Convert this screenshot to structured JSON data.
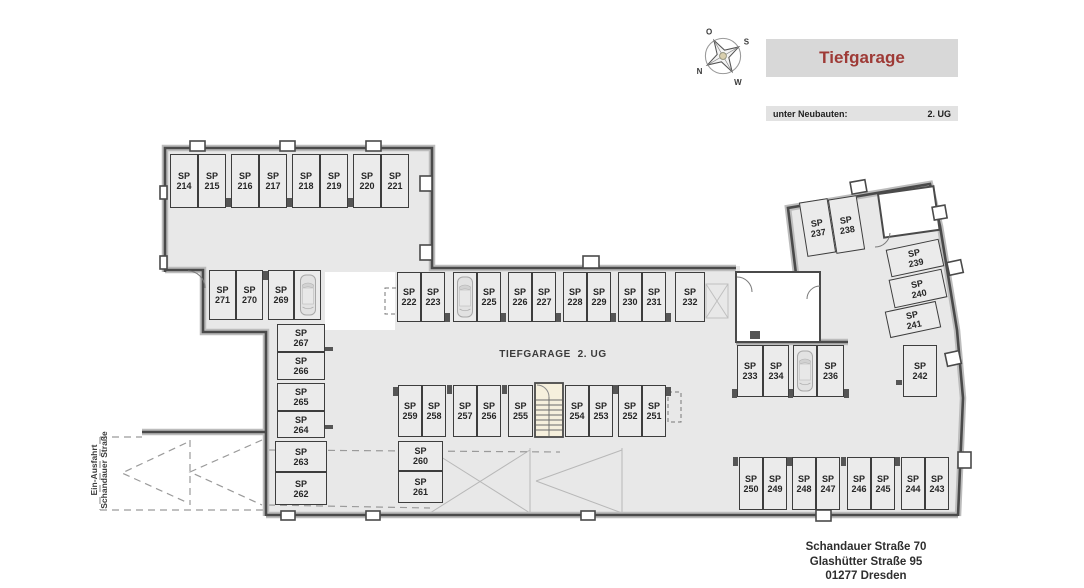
{
  "header": {
    "title": "Tiefgarage",
    "subtitle_left": "unter Neubauten:",
    "subtitle_right": "2. UG"
  },
  "compass": {
    "top": "O",
    "right": "S",
    "bottom": "W",
    "left": "N"
  },
  "plan": {
    "area_label": "TIEFGARAGE  2. UG",
    "entrance_line1": "Ein-Ausfahrt",
    "entrance_line2": "Schandauer Straße"
  },
  "footer": {
    "address_line1": "Schandauer Straße 70",
    "address_line2": "Glashütter Straße 95",
    "address_line3": "01277 Dresden"
  },
  "colors": {
    "accent_red": "#9e3a36",
    "floor": "#e8e8e8",
    "wall": "#4a4a4a",
    "stair_fill": "#f6f0dd"
  },
  "spots": [
    {
      "label": "SP",
      "num": "214"
    },
    {
      "label": "SP",
      "num": "215"
    },
    {
      "label": "SP",
      "num": "216"
    },
    {
      "label": "SP",
      "num": "217"
    },
    {
      "label": "SP",
      "num": "218"
    },
    {
      "label": "SP",
      "num": "219"
    },
    {
      "label": "SP",
      "num": "220"
    },
    {
      "label": "SP",
      "num": "221"
    },
    {
      "label": "SP",
      "num": "222"
    },
    {
      "label": "SP",
      "num": "223"
    },
    {
      "label": "SP",
      "num": "224"
    },
    {
      "label": "SP",
      "num": "225"
    },
    {
      "label": "SP",
      "num": "226"
    },
    {
      "label": "SP",
      "num": "227"
    },
    {
      "label": "SP",
      "num": "228"
    },
    {
      "label": "SP",
      "num": "229"
    },
    {
      "label": "SP",
      "num": "230"
    },
    {
      "label": "SP",
      "num": "231"
    },
    {
      "label": "SP",
      "num": "232"
    },
    {
      "label": "SP",
      "num": "233"
    },
    {
      "label": "SP",
      "num": "234"
    },
    {
      "label": "SP",
      "num": "235"
    },
    {
      "label": "SP",
      "num": "236"
    },
    {
      "label": "SP",
      "num": "237"
    },
    {
      "label": "SP",
      "num": "238"
    },
    {
      "label": "SP",
      "num": "239"
    },
    {
      "label": "SP",
      "num": "240"
    },
    {
      "label": "SP",
      "num": "241"
    },
    {
      "label": "SP",
      "num": "242"
    },
    {
      "label": "SP",
      "num": "243"
    },
    {
      "label": "SP",
      "num": "244"
    },
    {
      "label": "SP",
      "num": "245"
    },
    {
      "label": "SP",
      "num": "246"
    },
    {
      "label": "SP",
      "num": "247"
    },
    {
      "label": "SP",
      "num": "248"
    },
    {
      "label": "SP",
      "num": "249"
    },
    {
      "label": "SP",
      "num": "250"
    },
    {
      "label": "SP",
      "num": "251"
    },
    {
      "label": "SP",
      "num": "252"
    },
    {
      "label": "SP",
      "num": "253"
    },
    {
      "label": "SP",
      "num": "254"
    },
    {
      "label": "SP",
      "num": "255"
    },
    {
      "label": "SP",
      "num": "256"
    },
    {
      "label": "SP",
      "num": "257"
    },
    {
      "label": "SP",
      "num": "258"
    },
    {
      "label": "SP",
      "num": "259"
    },
    {
      "label": "SP",
      "num": "260"
    },
    {
      "label": "SP",
      "num": "261"
    },
    {
      "label": "SP",
      "num": "262"
    },
    {
      "label": "SP",
      "num": "263"
    },
    {
      "label": "SP",
      "num": "264"
    },
    {
      "label": "SP",
      "num": "265"
    },
    {
      "label": "SP",
      "num": "266"
    },
    {
      "label": "SP",
      "num": "267"
    },
    {
      "label": "SP",
      "num": "268"
    },
    {
      "label": "SP",
      "num": "269"
    },
    {
      "label": "SP",
      "num": "270"
    },
    {
      "label": "SP",
      "num": "271"
    }
  ],
  "cars_on": [
    "224",
    "235",
    "268"
  ]
}
